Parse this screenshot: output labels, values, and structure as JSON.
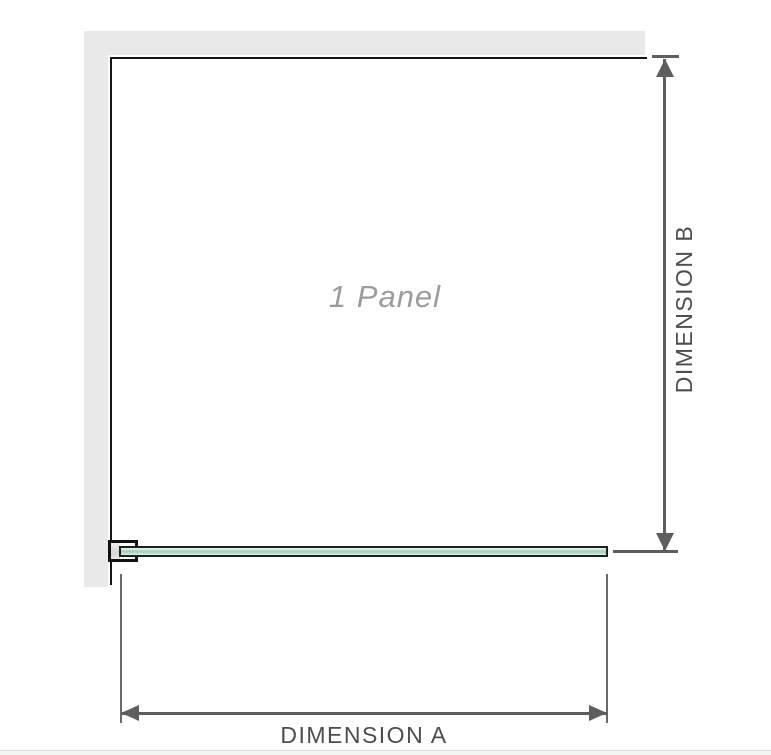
{
  "diagram": {
    "title": "shower-screen-panel-dimension-diagram",
    "panel_label": "1 Panel",
    "dimensions": {
      "horizontal": {
        "label": "DIMENSION A"
      },
      "vertical": {
        "label": "DIMENSION B"
      }
    },
    "parts": {
      "wall": "wall (top and left, grey strip)",
      "clamp": "wall-mount glass clamp at bottom left",
      "glass": "glass panel shown in plan view (green bar)"
    },
    "colors": {
      "wall_grey": "#e9e9e9",
      "panel_outline": "#141414",
      "dimension_line": "#5e5e5e",
      "dimension_text": "#4d4d4d",
      "panel_label_text": "#9c9c9c",
      "glass_green": "#9fd2b5",
      "glass_green_light": "#e6f5ec",
      "bottom_strip": "#f3f5f1"
    }
  }
}
